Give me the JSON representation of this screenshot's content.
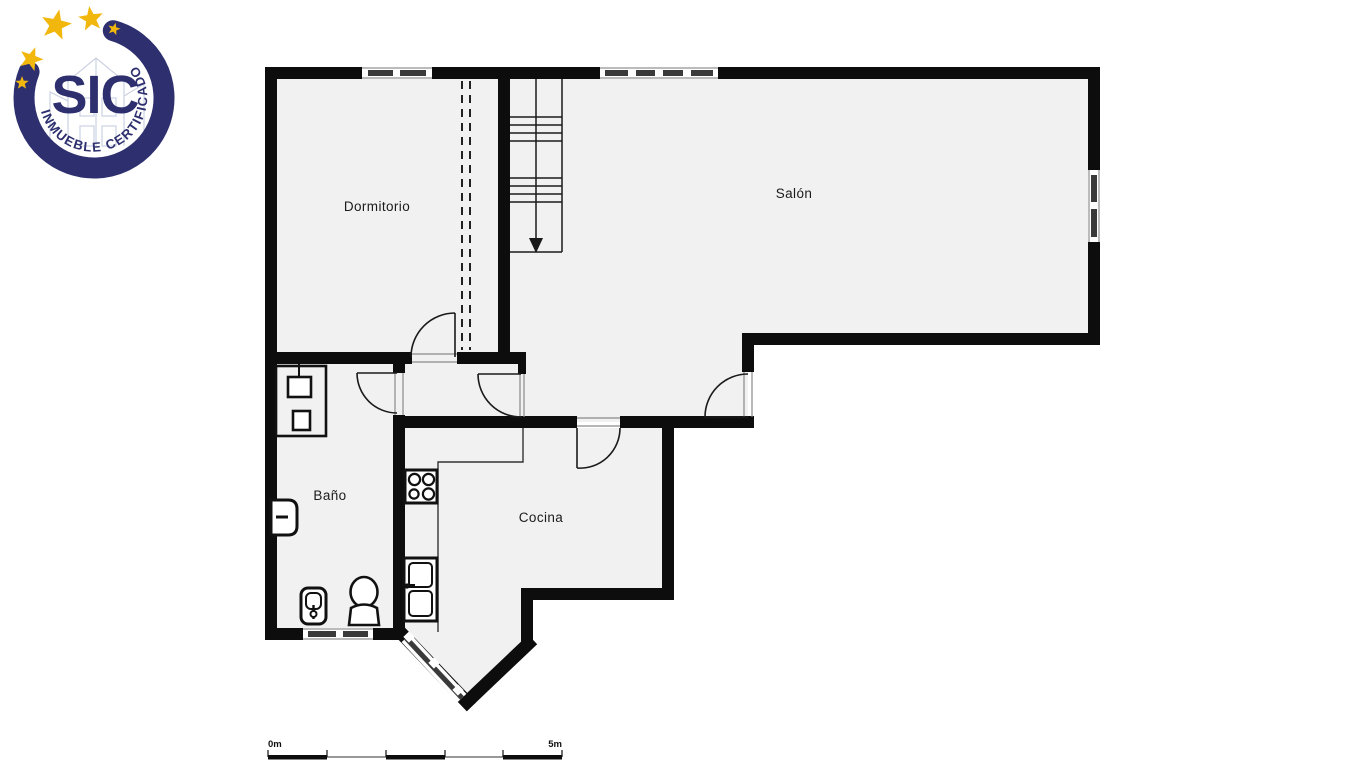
{
  "logo": {
    "acronym": "SIC",
    "tagline": "INMUEBLE CERTIFICADO",
    "navy": "#2d2f6e",
    "gold": "#f2b70d",
    "building_line_color": "#ccd1e2"
  },
  "floorplan": {
    "wall_color": "#0d0d0d",
    "floor_color": "#f1f1f1",
    "window_band_color": "#3a3a3a",
    "rooms": [
      {
        "label": "Dormitorio"
      },
      {
        "label": "Salón"
      },
      {
        "label": "Baño"
      },
      {
        "label": "Cocina"
      }
    ]
  },
  "scale_bar": {
    "start_label": "0m",
    "end_label": "5m"
  }
}
